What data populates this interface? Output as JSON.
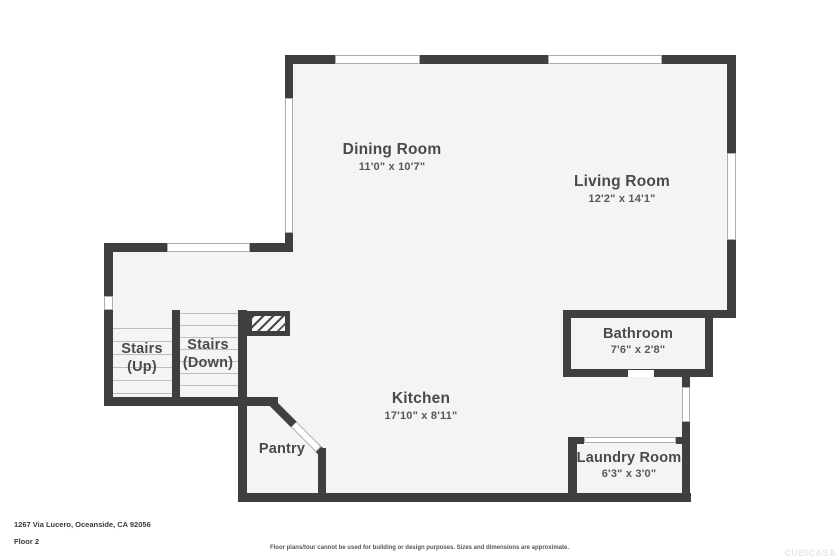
{
  "floor_plan": {
    "address": "1267 Via Lucero, Oceanside, CA 92056",
    "floor_label": "Floor 2",
    "disclaimer": "Floor plans/tour cannot be used for building or design purposes. Sizes and dimensions are approximate.",
    "watermark": "CUBICASA",
    "colors": {
      "wall": "#3f3f3f",
      "floor": "#f4f4f3",
      "window_edge": "#adadad",
      "step_line": "#bdbdbd",
      "label_text": "#4a4a4a"
    },
    "rooms": {
      "dining": {
        "name": "Dining Room",
        "dimensions": "11'0\" x 10'7\""
      },
      "living": {
        "name": "Living Room",
        "dimensions": "12'2\" x 14'1\""
      },
      "bathroom": {
        "name": "Bathroom",
        "dimensions": "7'6\" x 2'8\""
      },
      "kitchen": {
        "name": "Kitchen",
        "dimensions": "17'10\" x 8'11\""
      },
      "pantry": {
        "name": "Pantry"
      },
      "laundry": {
        "name": "Laundry Room",
        "dimensions": "6'3\" x 3'0\""
      },
      "stairs_up": {
        "name": "Stairs",
        "qualifier": "(Up)"
      },
      "stairs_down": {
        "name": "Stairs",
        "qualifier": "(Down)"
      }
    }
  }
}
